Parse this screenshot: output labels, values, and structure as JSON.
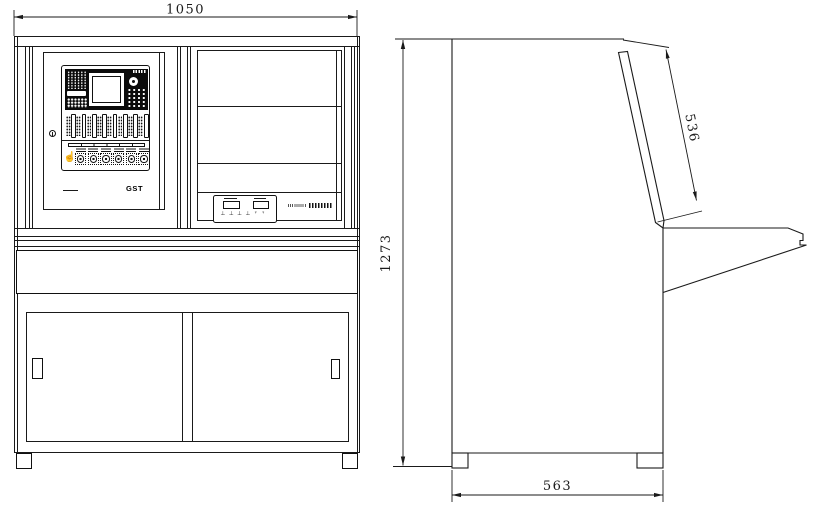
{
  "dimensions": {
    "front_width": "1050",
    "overall_height": "1273",
    "tilt_panel_length": "536",
    "base_depth": "563"
  },
  "front_view": {
    "logo_text": "GST",
    "panel": {
      "strip_count": 8,
      "knob_count": 6,
      "hand_icon": "☝"
    },
    "operator_box": {
      "symbols_left": "⊥ ⊥ ⊥ ⊥",
      "symbols_right": "♀ ♀"
    }
  }
}
